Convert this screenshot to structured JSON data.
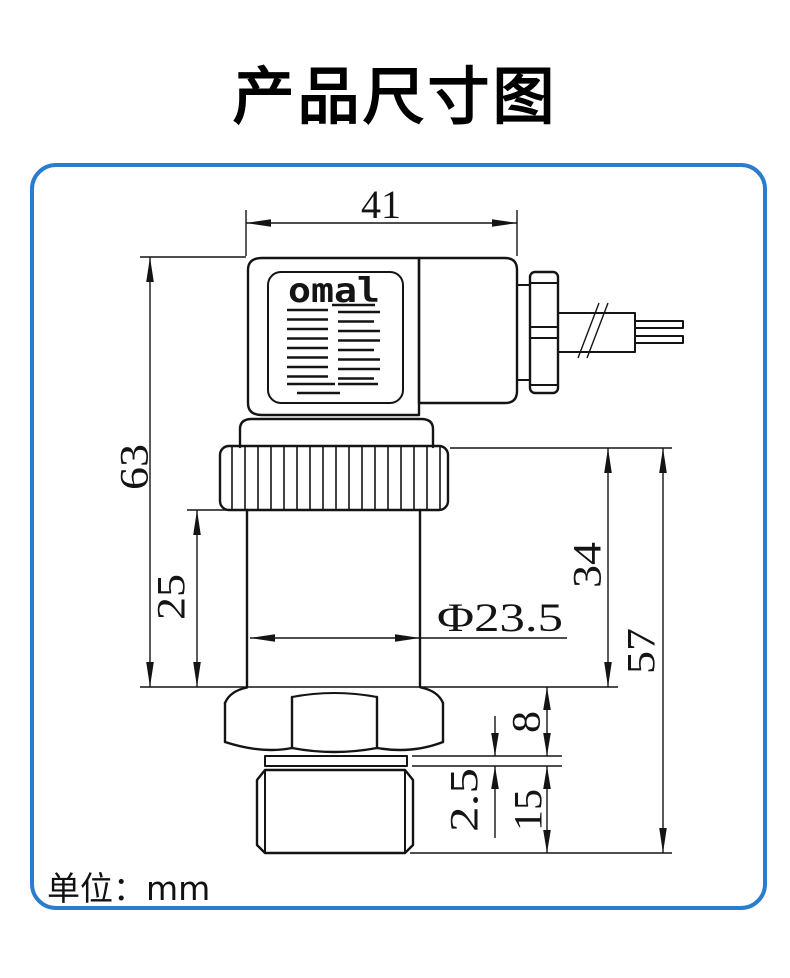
{
  "page": {
    "title": "产品尺寸图",
    "unit_label": "单位：mm",
    "frame_color": "#2b7ccd",
    "line_color": "#141414"
  },
  "drawing": {
    "brand_logo": "omal",
    "dims": {
      "connector_width": "41",
      "overall_height": "63",
      "body_height": "25",
      "body_diameter": "Φ23.5",
      "lower_section_height": "34",
      "lower_overall_height": "57",
      "hex_thickness": "8",
      "groove_thickness": "2.5",
      "thread_length": "15"
    }
  }
}
